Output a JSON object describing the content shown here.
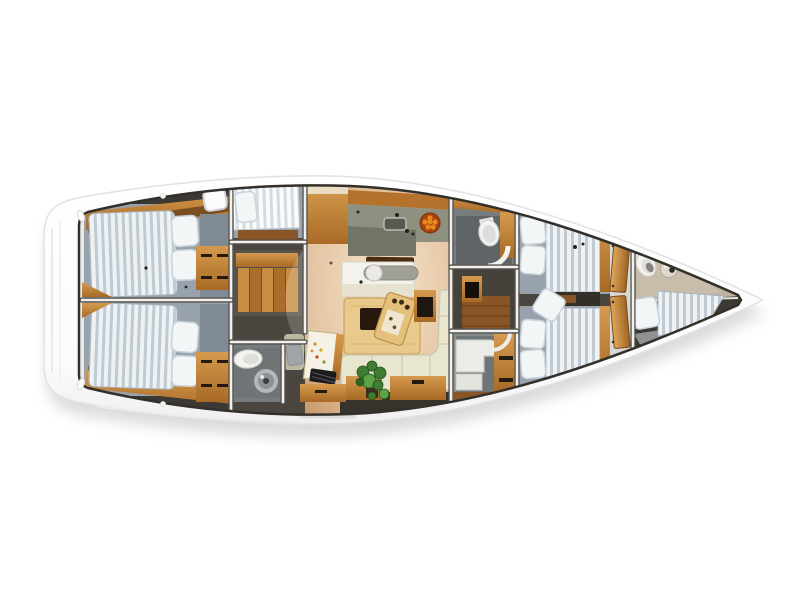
{
  "scene": {
    "type": "yacht-interior-floor-plan",
    "orientation": "bow-right",
    "background": "#ffffff",
    "description": "Top-down 3D rendered deck plan of a sailing yacht interior, hull white, bow pointing right"
  },
  "palette": {
    "hull": "#ffffff",
    "hull-edge": "#e2e2e2",
    "interior-dark": "#3c3833",
    "wall": "#f1f1ef",
    "wall-shadow": "#55504a",
    "wood": "#c98c3e",
    "wood-dark": "#8a5526",
    "wood-floor": "#70451c",
    "counter": "#8f9180",
    "counter-dark": "#6e7265",
    "mattress": "#eef2f4",
    "mattress-stripe": "#bfcad2",
    "bedframe": "#97a2ac",
    "pillow": "#f3f6f7",
    "sofa": "#e9e6d0",
    "sofa-seam": "#cdc9ad",
    "table": "#e9c98c",
    "table-inset": "#27190d",
    "white-furniture": "#f4f2ec",
    "gray-bar": "#a0a098",
    "head-wall": "#777c7e",
    "head-floor": "#6f7476",
    "porcelain": "#f3f3f1",
    "taupe-floor": "#bdb1a0",
    "plant": "#3f7d33",
    "fruit": "#e8871c",
    "fruit-bowl": "#a84410",
    "chart-paper": "#f5f1e6",
    "shadow": "#9a9a9a"
  },
  "rooms": [
    {
      "id": "aft-cabin-port",
      "label": "Aft cabin port with double berth and two pillows"
    },
    {
      "id": "aft-cabin-starboard",
      "label": "Aft cabin starboard with double berth and two pillows"
    },
    {
      "id": "side-berth",
      "label": "Side berth with deck hatch and pillow"
    },
    {
      "id": "companionway",
      "label": "Companionway stairs with storage drawers"
    },
    {
      "id": "aft-head",
      "label": "Aft head with toilet and round basin"
    },
    {
      "id": "galley",
      "label": "Galley with L-shaped counter, sink and fruit bowl"
    },
    {
      "id": "salon",
      "label": "Salon with sideboard, dining table, serving tray, L-shaped sofa and plant"
    },
    {
      "id": "nav-station",
      "label": "Navigation station with chart table, nautical chart, keyboard and seat"
    },
    {
      "id": "mid-head",
      "label": "Day head with toilet and wood cabinet"
    },
    {
      "id": "shower-room",
      "label": "Shower room with vanity and wood drawers"
    },
    {
      "id": "forward-cabin",
      "label": "Forward cabin with twin striped berths, pillows and loose cushion"
    },
    {
      "id": "doors",
      "label": "Two wooden cabin doors"
    },
    {
      "id": "bow-head",
      "label": "Bow head with toilet and round sink"
    },
    {
      "id": "bow-berth",
      "label": "Bow berth with pillow and striped mattress"
    }
  ]
}
